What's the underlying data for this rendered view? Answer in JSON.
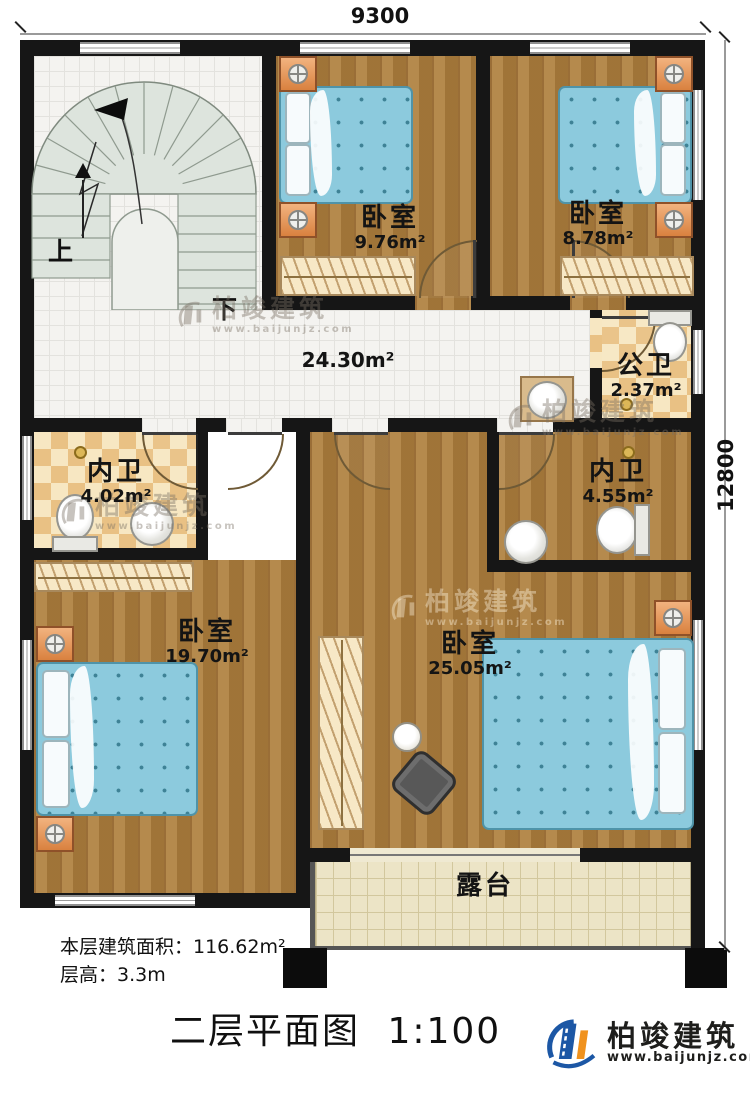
{
  "dimensions": {
    "top_width": "9300",
    "right_height": "12800"
  },
  "stairs": {
    "up_label": "上",
    "down_label": "下"
  },
  "hall": {
    "area": "24.30m²"
  },
  "rooms": {
    "bedroom_top_mid": {
      "name": "卧室",
      "area": "9.76m²"
    },
    "bedroom_top_right": {
      "name": "卧室",
      "area": "8.78m²"
    },
    "public_bath": {
      "name": "公卫",
      "area": "2.37m²"
    },
    "ensuite_left": {
      "name": "内卫",
      "area": "4.02m²"
    },
    "ensuite_right": {
      "name": "内卫",
      "area": "4.55m²"
    },
    "bedroom_bottom_left": {
      "name": "卧室",
      "area": "19.70m²"
    },
    "bedroom_bottom_right": {
      "name": "卧室",
      "area": "25.05m²"
    },
    "terrace": {
      "name": "露台"
    }
  },
  "notes": {
    "floor_area": "本层建筑面积：116.62m²",
    "floor_height": "层高：3.3m"
  },
  "title": {
    "name": "二层平面图",
    "scale": "1:100"
  },
  "brand": {
    "name": "柏竣建筑",
    "url": "www.baijunjz.com"
  },
  "watermark": {
    "name": "柏竣建筑",
    "url": "www.baijunjz.com"
  },
  "colors": {
    "wall": "#161616",
    "wood_floor": "#a97c3e",
    "bath_tile": "#e9c184",
    "terrace_tile": "#ece4c6",
    "bed": "#8ccadd",
    "brand_blue": "#1c57a5",
    "brand_orange": "#f0921e"
  }
}
